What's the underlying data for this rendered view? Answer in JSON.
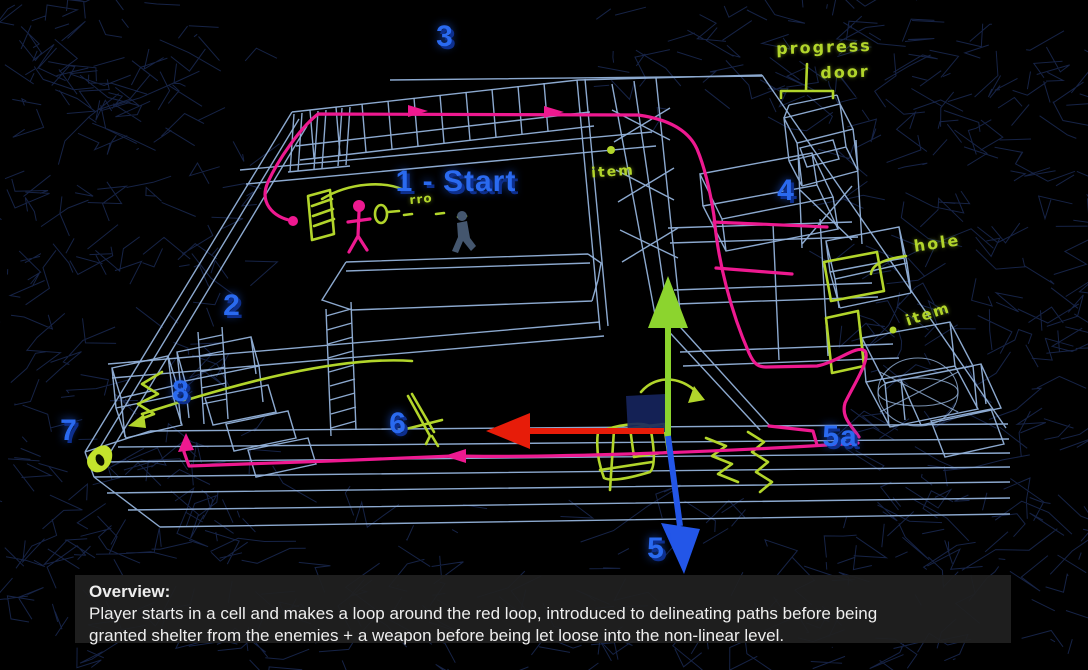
{
  "viewport": {
    "description": "3D wireframe game level blockout with hand-drawn design annotations"
  },
  "annotations": {
    "start_label": "1 - Start",
    "numbers": {
      "n2": "2",
      "n3": "3",
      "n4": "4",
      "n5": "5",
      "n5a": "5a",
      "n6": "6",
      "n7": "7",
      "n8": "8"
    },
    "notes": {
      "progress": "progress",
      "door": "door",
      "hole": "hole",
      "item_top": "item",
      "item_right": "item",
      "rro": "rro"
    }
  },
  "overview": {
    "title": "Overview:",
    "line1": "Player starts in a cell and makes a loop around the red loop, introduced to delineating paths before being",
    "line2": "granted shelter from the enemies + a weapon before being let loose into the non-linear level."
  },
  "colors": {
    "background": "#000000",
    "wireframe": "#93b2da",
    "wireframe_far": "#1c2c58",
    "path_pink": "#ee1990",
    "note_green": "#b2d52b",
    "label_blue": "#2a6af0",
    "label_shadow": "#0d2f8e",
    "axis_up_green": "#8cd42e",
    "axis_left_red": "#e71c09",
    "axis_down_blue": "#2356e8",
    "overlay_text": "#eeeeee"
  }
}
